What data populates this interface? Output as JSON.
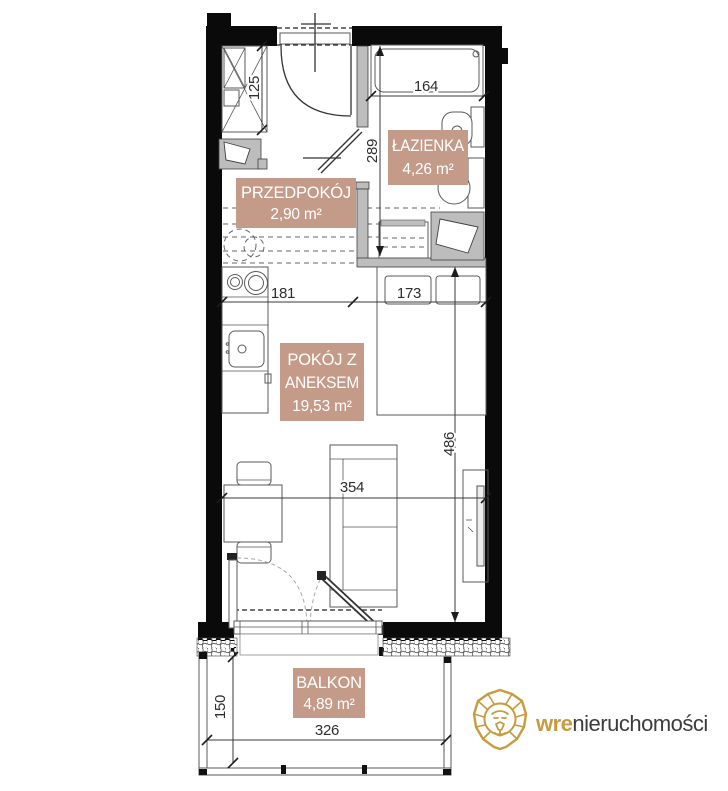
{
  "rooms": {
    "hallway": {
      "name": "PRZEDPOKÓJ",
      "area": "2,90 m²"
    },
    "bathroom": {
      "name": "ŁAZIENKA",
      "area": "4,26 m²"
    },
    "living": {
      "name_line1": "POKÓJ Z",
      "name_line2": "ANEKSEM",
      "area": "19,53 m²"
    },
    "balcony": {
      "name": "BALKON",
      "area": "4,89 m²"
    }
  },
  "dimensions_cm": {
    "wardrobe": "125",
    "bathtub": "164",
    "hallway_depth": "289",
    "kitchen_run": "181",
    "bed": "173",
    "room_length": "486",
    "room_width": "354",
    "balcony_depth": "150",
    "balcony_width": "326"
  },
  "branding": {
    "name_bold": "wre",
    "name_regular": "nieruchomości"
  },
  "colors": {
    "label_background": "#c49a88",
    "label_text": "#ffffff",
    "wall": "#0a0a0a",
    "partition": "#bdbdbd",
    "logo_gold": "#c79b3f",
    "logo_text": "#3c3c3b"
  }
}
